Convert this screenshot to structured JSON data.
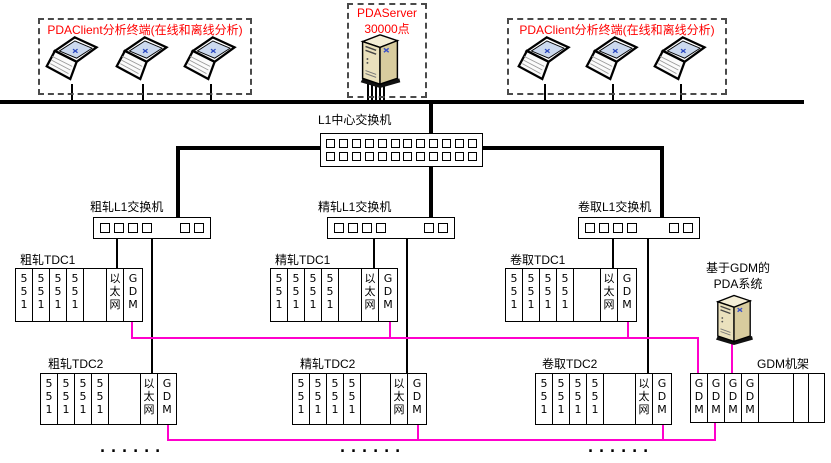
{
  "colors": {
    "accent_red": "#FF0000",
    "gdm_link_magenta": "#FF00CC",
    "line_black": "#000000",
    "server_body_beige": "#EAE1BD"
  },
  "icons": {
    "laptop": "laptop-icon",
    "server": "server-tower-icon",
    "switch_port": "switch-port"
  },
  "groups": {
    "client_left_label": "PDAClient分析终端(在线和离线分析)",
    "client_right_label": "PDAClient分析终端(在线和离线分析)",
    "server_label_line1": "PDAServer",
    "server_label_line2": "30000点"
  },
  "central_switch_label": "L1中心交换机",
  "switch_labels": {
    "roughing": "粗轧L1交换机",
    "finishing": "精轧L1交换机",
    "coiling": "卷取L1交换机"
  },
  "tdc": [
    {
      "label": "粗轧TDC1",
      "cells": [
        "5\n5\n1",
        "5\n5\n1",
        "5\n5\n1",
        "5\n5\n1",
        "",
        "以\n太\n网",
        "G\nD\nM"
      ]
    },
    {
      "label": "精轧TDC1",
      "cells": [
        "5\n5\n1",
        "5\n5\n1",
        "5\n5\n1",
        "5\n5\n1",
        "",
        "以\n太\n网",
        "G\nD\nM"
      ]
    },
    {
      "label": "卷取TDC1",
      "cells": [
        "5\n5\n1",
        "5\n5\n1",
        "5\n5\n1",
        "5\n5\n1",
        "",
        "以\n太\n网",
        "G\nD\nM"
      ]
    },
    {
      "label": "粗轧TDC2",
      "cells": [
        "5\n5\n1",
        "5\n5\n1",
        "5\n5\n1",
        "5\n5\n1",
        "",
        "以\n太\n网",
        "G\nD\nM"
      ]
    },
    {
      "label": "精轧TDC2",
      "cells": [
        "5\n5\n1",
        "5\n5\n1",
        "5\n5\n1",
        "5\n5\n1",
        "",
        "以\n太\n网",
        "G\nD\nM"
      ]
    },
    {
      "label": "卷取TDC2",
      "cells": [
        "5\n5\n1",
        "5\n5\n1",
        "5\n5\n1",
        "5\n5\n1",
        "",
        "以\n太\n网",
        "G\nD\nM"
      ]
    }
  ],
  "gdm_rack": {
    "label": "GDM机架",
    "cells": [
      "G\nD\nM",
      "G\nD\nM",
      "G\nD\nM",
      "G\nD\nM",
      "",
      "",
      ""
    ]
  },
  "gdm_pda_label_line1": "基于GDM的",
  "gdm_pda_label_line2": "PDA系统",
  "ellipsis": "......"
}
